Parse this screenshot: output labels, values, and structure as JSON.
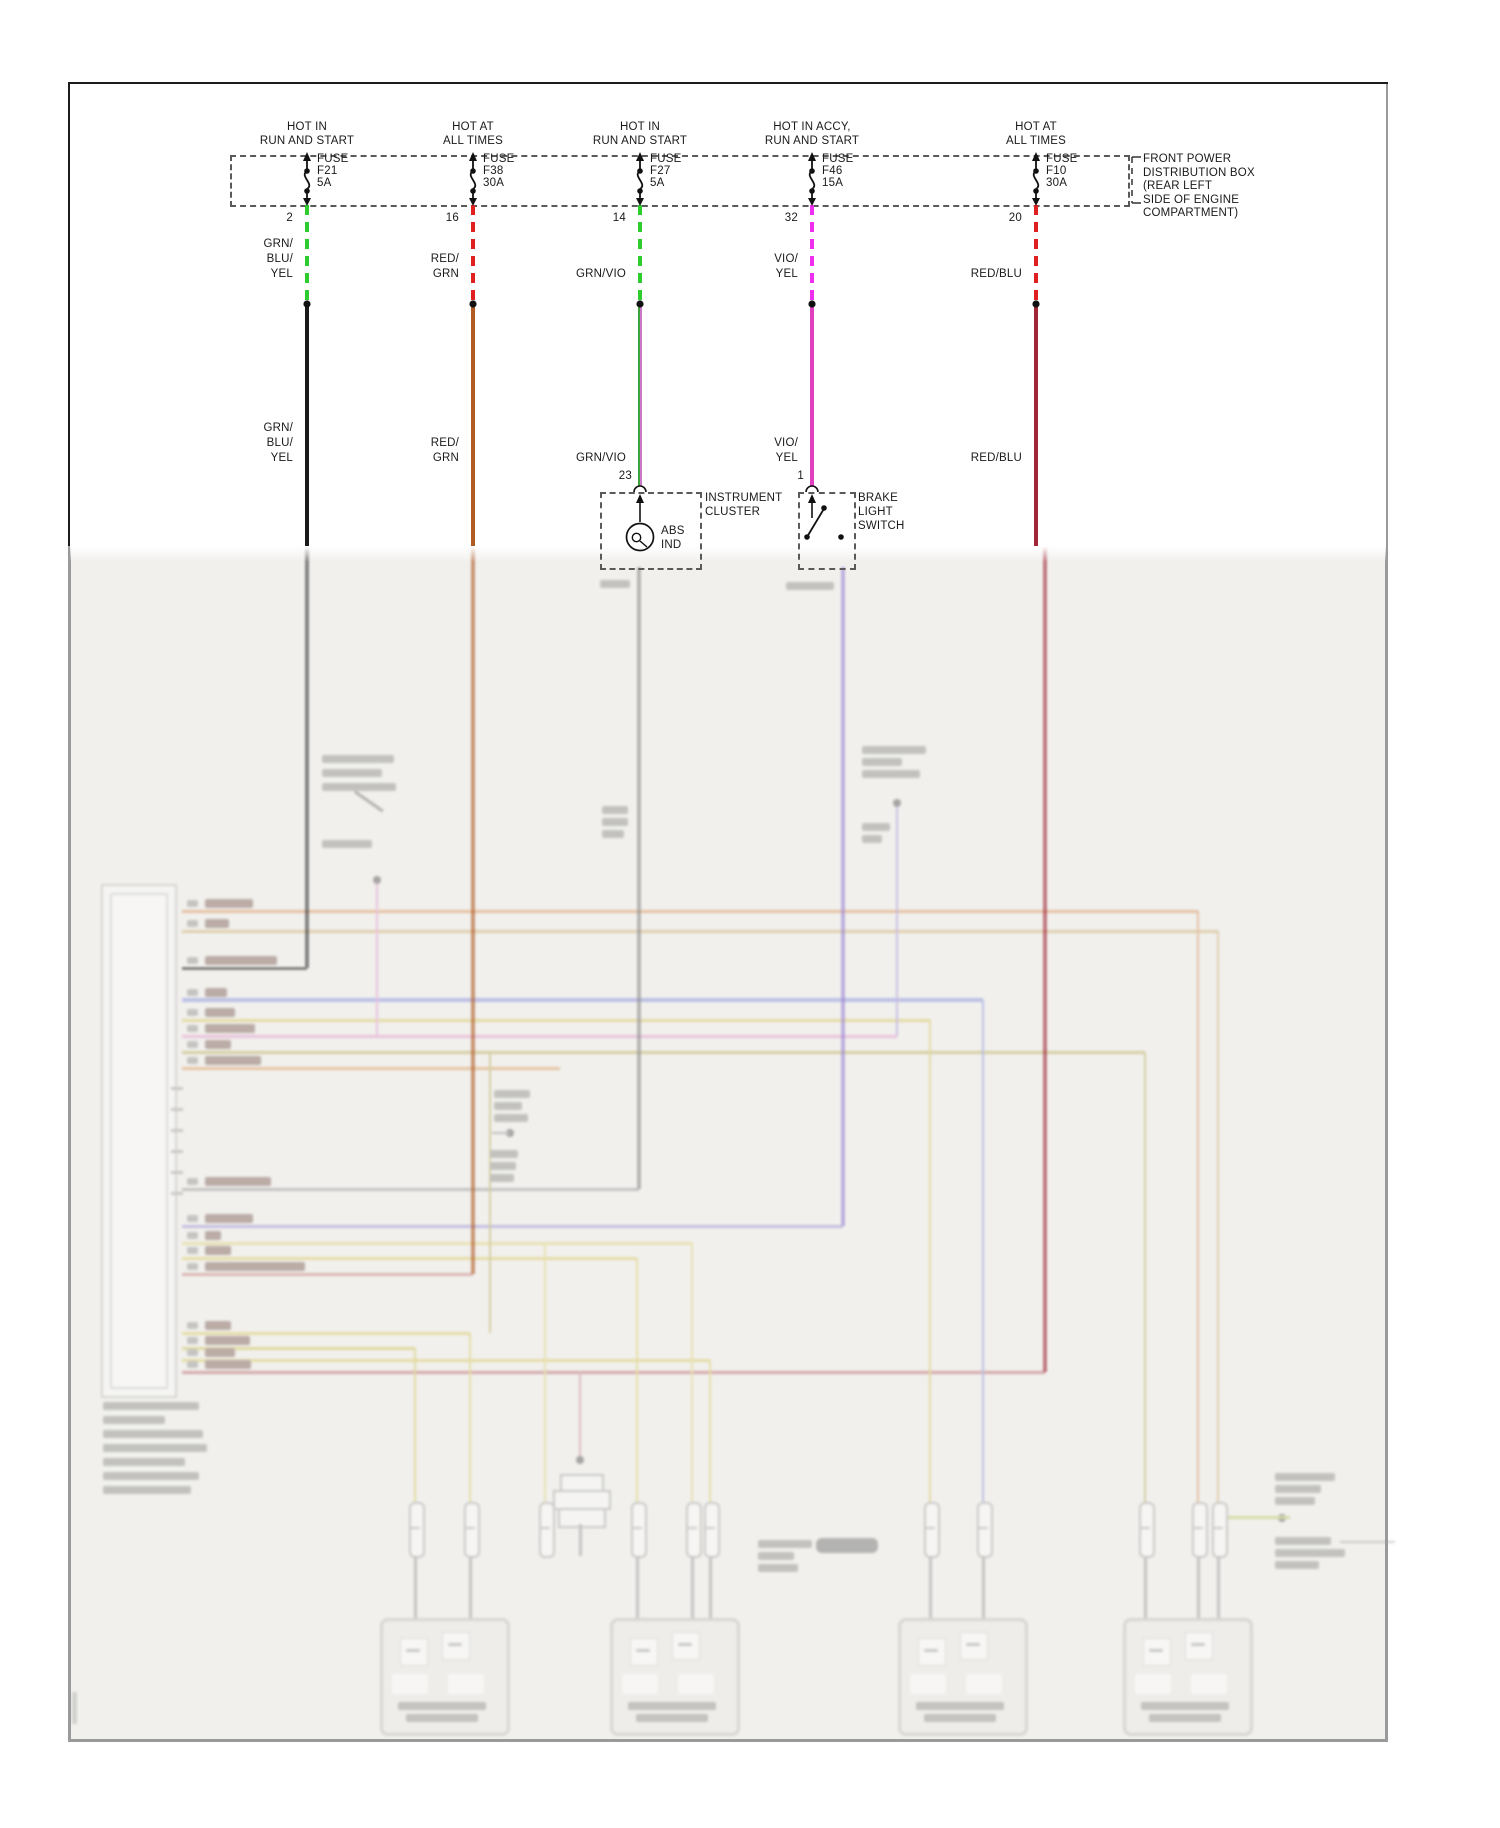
{
  "title_note": "automotive ABS wiring schematic, top crisp / bottom washed-out",
  "colors": {
    "frame_dark": "#1c1c1c",
    "frame_gray": "#9a9a9a",
    "faded_paper": "#f1f0ed",
    "dash_green": "#2ecc2e",
    "dash_red": "#e02020",
    "dash_magenta": "#ee30ee"
  },
  "distribution_box_note": [
    "FRONT POWER",
    "DISTRIBUTION BOX",
    "(REAR LEFT",
    "SIDE OF ENGINE",
    "COMPARTMENT)"
  ],
  "circuits": [
    {
      "hot": [
        "HOT IN",
        "RUN AND START"
      ],
      "fuse_label": "FUSE",
      "fuse_id": "F21",
      "fuse_amps": "5A",
      "pin": "2",
      "wire_color_top": [
        "GRN/",
        "BLU/",
        "YEL"
      ],
      "wire_color_mid": [
        "GRN/",
        "BLU/",
        "YEL"
      ],
      "dash_color": "#2ecc2e",
      "wire_color": "#1a1a1a"
    },
    {
      "hot": [
        "HOT AT",
        "ALL TIMES"
      ],
      "fuse_label": "FUSE",
      "fuse_id": "F38",
      "fuse_amps": "30A",
      "pin": "16",
      "wire_color_top": [
        "RED/",
        "GRN"
      ],
      "wire_color_mid": [
        "RED/",
        "GRN"
      ],
      "dash_color": "#e02020",
      "wire_color": "#b05a24"
    },
    {
      "hot": [
        "HOT IN",
        "RUN AND START"
      ],
      "fuse_label": "FUSE",
      "fuse_id": "F27",
      "fuse_amps": "5A",
      "pin": "14",
      "wire_color_top": [
        "GRN/VIO"
      ],
      "wire_color_mid": [
        "GRN/VIO"
      ],
      "dash_color": "#2ecc2e",
      "wire_color": [
        "#3aa33a",
        "#cc77cc"
      ]
    },
    {
      "hot": [
        "HOT IN ACCY,",
        "RUN AND START"
      ],
      "fuse_label": "FUSE",
      "fuse_id": "F46",
      "fuse_amps": "15A",
      "pin": "32",
      "wire_color_top": [
        "VIO/",
        "YEL"
      ],
      "wire_color_mid": [
        "VIO/",
        "YEL"
      ],
      "dash_color": "#ee30ee",
      "wire_color": "#e040c0"
    },
    {
      "hot": [
        "HOT AT",
        "ALL TIMES"
      ],
      "fuse_label": "FUSE",
      "fuse_id": "F10",
      "fuse_amps": "30A",
      "pin": "20",
      "wire_color_top": [
        "RED/BLU"
      ],
      "wire_color_mid": [
        "RED/BLU"
      ],
      "dash_color": "#e02020",
      "wire_color": "#a02535"
    }
  ],
  "instrument_cluster": {
    "pin": "23",
    "name": [
      "INSTRUMENT",
      "CLUSTER"
    ],
    "indicator": [
      "ABS",
      "IND"
    ]
  },
  "brake_light_switch": {
    "pin": "1",
    "name": [
      "BRAKE",
      "LIGHT",
      "SWITCH"
    ]
  },
  "faded_geometry": {
    "module_box": {
      "outer": [
        101,
        884,
        72,
        510
      ],
      "inner": [
        110,
        893,
        54,
        492
      ]
    },
    "rows_x_start": 182,
    "rows": [
      [
        911,
        "#d8874a",
        1198,
        48
      ],
      [
        931,
        "#c9a45f",
        1218,
        24
      ],
      [
        968,
        "#3c3c3c",
        307,
        72
      ],
      [
        1000,
        "#7b86d8",
        983,
        22
      ],
      [
        1020,
        "#d4c14f",
        930,
        30
      ],
      [
        1036,
        "#e08cc8",
        897,
        50
      ],
      [
        1052,
        "#b3a648",
        1145,
        26
      ],
      [
        1068,
        "#d6924a",
        560,
        56
      ],
      [
        1189,
        "#8d8d8d",
        639,
        66
      ],
      [
        1226,
        "#8f83d2",
        843,
        48
      ],
      [
        1243,
        "#dccf6e",
        692,
        16
      ],
      [
        1258,
        "#d6c653",
        637,
        26
      ],
      [
        1274,
        "#c4716e",
        473,
        100
      ],
      [
        1333,
        "#d6c653",
        470,
        26
      ],
      [
        1348,
        "#ccbe45",
        415,
        45
      ],
      [
        1360,
        "#d6c653",
        710,
        30
      ],
      [
        1372,
        "#b05058",
        1045,
        46
      ]
    ],
    "main_drops": [
      [
        307,
        546,
        968,
        "#3c3c3c"
      ],
      [
        473,
        546,
        1274,
        "#b05a24"
      ],
      [
        639,
        567,
        1189,
        "#8f8f8f"
      ],
      [
        843,
        567,
        1226,
        "#9b85d4"
      ],
      [
        1045,
        546,
        1372,
        "#a02838"
      ]
    ],
    "branch_drops": [
      [
        377,
        880,
        1036,
        "#e08cc8"
      ],
      [
        897,
        803,
        1036,
        "#9b85d4"
      ],
      [
        490,
        1052,
        1333,
        "#b3a648"
      ],
      [
        545,
        1243,
        1502,
        "#dccf6e"
      ],
      [
        580,
        1372,
        1460,
        "#c47a96"
      ],
      [
        415,
        1348,
        1502,
        "#ccbe45"
      ],
      [
        470,
        1333,
        1502,
        "#d6c653"
      ],
      [
        637,
        1258,
        1502,
        "#d6c653"
      ],
      [
        692,
        1243,
        1502,
        "#dccf6e"
      ],
      [
        710,
        1360,
        1502,
        "#d6c653"
      ],
      [
        930,
        1020,
        1502,
        "#d4c14f"
      ],
      [
        983,
        1000,
        1502,
        "#7b86d8"
      ],
      [
        1145,
        1052,
        1502,
        "#b3a648"
      ],
      [
        1198,
        911,
        1502,
        "#d8874a"
      ],
      [
        1218,
        931,
        1502,
        "#c9a45f"
      ]
    ],
    "connector_stubs_x": [
      415,
      470,
      545,
      637,
      692,
      710,
      930,
      983,
      1145,
      1198,
      1218
    ],
    "sensor_centers_x": [
      442,
      672,
      960,
      1185
    ],
    "splice_dots": [
      [
        377,
        880
      ],
      [
        897,
        803
      ],
      [
        510,
        1133
      ],
      [
        580,
        1460
      ],
      [
        1282,
        1518
      ]
    ],
    "unused_pin_ticks_y": [
      1087,
      1108,
      1129,
      1150,
      1171,
      1192
    ]
  }
}
